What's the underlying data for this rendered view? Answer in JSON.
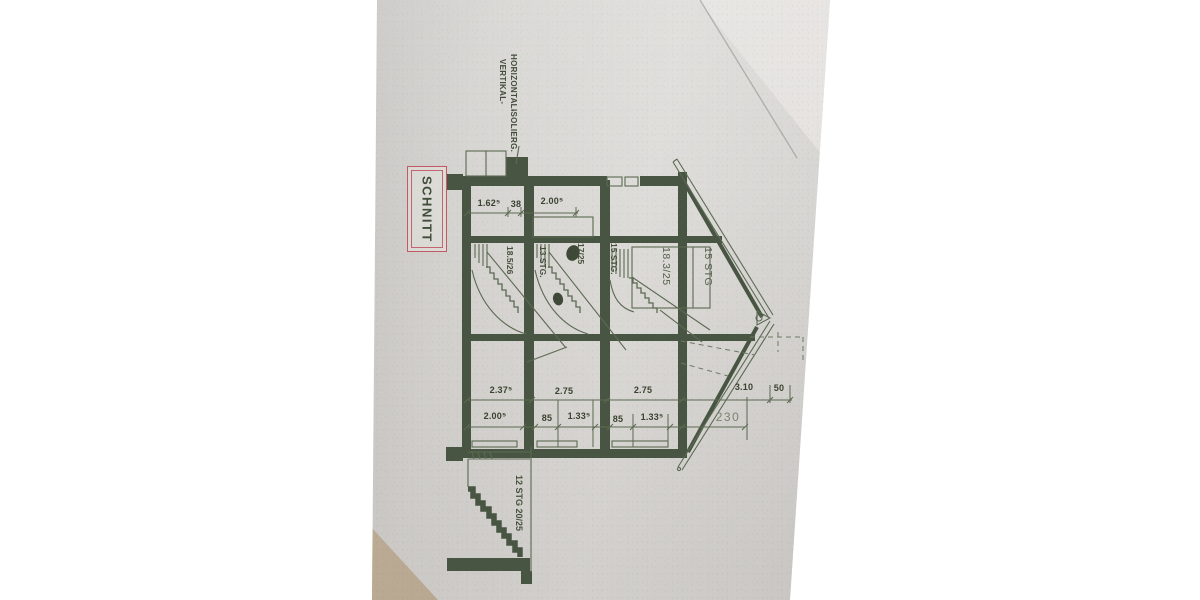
{
  "title_box": {
    "label": "SCHNITT"
  },
  "insulation_note": {
    "line1": "HORIZONTAL-",
    "line2": "VERTIKAL-",
    "line3": "ISOLIERG."
  },
  "stairs": {
    "flight1": {
      "count": "13 STG.",
      "ratio": "18.5/26"
    },
    "flight2": {
      "count": "15 STG.",
      "ratio": "17/25"
    },
    "flight3": {
      "count": "15 STG",
      "ratio": "18.3/25"
    },
    "basement": {
      "label": "12 STG 20/25"
    }
  },
  "dimensions": {
    "top_row": [
      "1.62⁵",
      "38",
      "2.00⁵"
    ],
    "room_widths": [
      "2.37⁵",
      "2.75",
      "2.75",
      "3.10",
      "50"
    ],
    "detail_widths": [
      "2.00⁵",
      "85",
      "1.33⁵",
      "85",
      "1.33⁵"
    ],
    "roof_width": "230"
  },
  "colors": {
    "ink_heavy": "#485542",
    "ink_thin": "#5b6a53",
    "title_red": "#c05a64",
    "paper": "#dbd9d6",
    "table": "#c6b5a0"
  }
}
